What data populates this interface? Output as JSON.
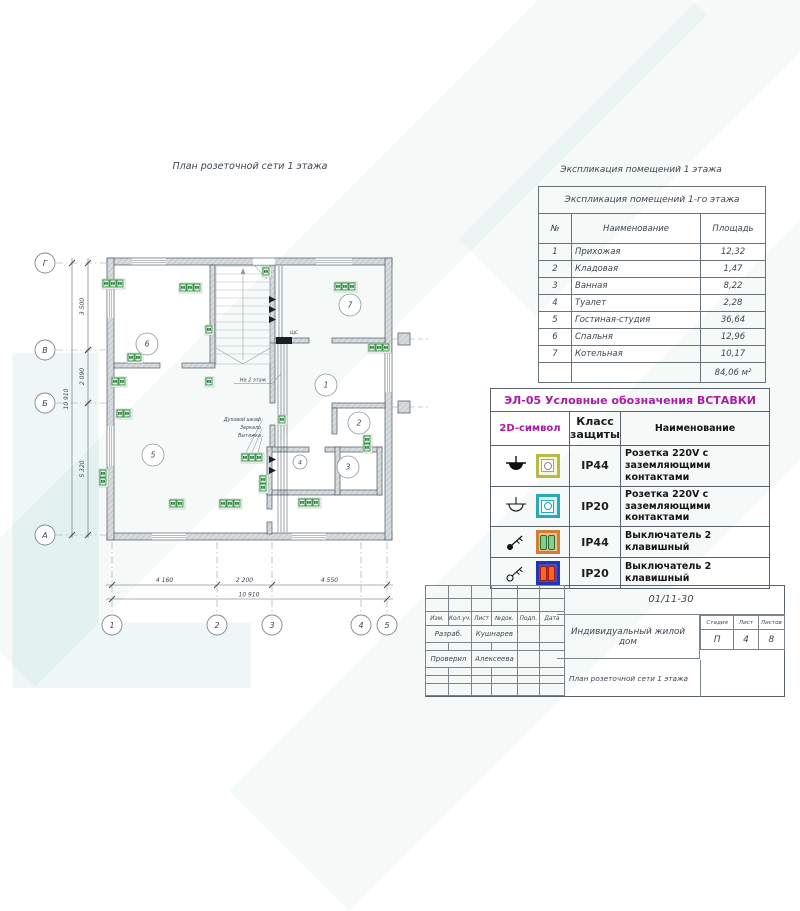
{
  "plan": {
    "title": "План розеточной сети 1 этажа",
    "panel_label": "ЩС",
    "stairs_label": "На 2 этаж",
    "annotations": [
      "Духовой шкаф",
      "Зеркало",
      "Вытяжка"
    ],
    "h_axes": [
      {
        "label": "Г",
        "y": 33
      },
      {
        "label": "В",
        "y": 120
      },
      {
        "label": "Б",
        "y": 173
      },
      {
        "label": "А",
        "y": 305
      }
    ],
    "v_axes": [
      {
        "label": "1",
        "x": 92
      },
      {
        "label": "2",
        "x": 197
      },
      {
        "label": "3",
        "x": 252
      },
      {
        "label": "4",
        "x": 341
      },
      {
        "label": "5",
        "x": 367
      }
    ],
    "left_dims": [
      {
        "label": "3 500",
        "from": 33,
        "to": 120
      },
      {
        "label": "2 090",
        "from": 120,
        "to": 173
      },
      {
        "label": "5 320",
        "from": 173,
        "to": 305
      }
    ],
    "left_total": "10 910",
    "bottom_dims": [
      {
        "label": "4 160",
        "from": 92,
        "to": 197
      },
      {
        "label": "2 200",
        "from": 197,
        "to": 252
      },
      {
        "label": "4 550",
        "from": 252,
        "to": 367
      }
    ],
    "bottom_total": "10 910",
    "rooms": [
      {
        "n": "1",
        "x": 306,
        "y": 155
      },
      {
        "n": "2",
        "x": 339,
        "y": 193
      },
      {
        "n": "3",
        "x": 328,
        "y": 237
      },
      {
        "n": "4",
        "x": 280,
        "y": 232,
        "r": 7
      },
      {
        "n": "5",
        "x": 133,
        "y": 225
      },
      {
        "n": "6",
        "x": 127,
        "y": 114
      },
      {
        "n": "7",
        "x": 330,
        "y": 75
      }
    ],
    "sockets": [
      {
        "x": 83,
        "y": 50,
        "n": 3,
        "o": "h"
      },
      {
        "x": 160,
        "y": 54,
        "n": 3,
        "o": "h"
      },
      {
        "x": 243,
        "y": 38,
        "n": 1,
        "o": "v"
      },
      {
        "x": 315,
        "y": 53,
        "n": 3,
        "o": "h"
      },
      {
        "x": 108,
        "y": 124,
        "n": 2,
        "o": "h"
      },
      {
        "x": 186,
        "y": 96,
        "n": 1,
        "o": "v"
      },
      {
        "x": 349,
        "y": 114,
        "n": 3,
        "o": "h"
      },
      {
        "x": 92,
        "y": 148,
        "n": 2,
        "o": "h"
      },
      {
        "x": 186,
        "y": 148,
        "n": 1,
        "o": "v"
      },
      {
        "x": 97,
        "y": 180,
        "n": 2,
        "o": "h"
      },
      {
        "x": 222,
        "y": 224,
        "n": 3,
        "o": "h"
      },
      {
        "x": 200,
        "y": 270,
        "n": 3,
        "o": "h"
      },
      {
        "x": 279,
        "y": 269,
        "n": 3,
        "o": "h"
      },
      {
        "x": 240,
        "y": 246,
        "n": 2,
        "o": "v"
      },
      {
        "x": 259,
        "y": 186,
        "n": 1,
        "o": "h"
      },
      {
        "x": 344,
        "y": 206,
        "n": 2,
        "o": "v"
      },
      {
        "x": 80,
        "y": 240,
        "n": 2,
        "o": "v"
      },
      {
        "x": 150,
        "y": 270,
        "n": 2,
        "o": "h"
      }
    ]
  },
  "explication": {
    "caption": "Экспликация помещений 1 этажа",
    "title": "Экспликация помещений 1-го этажа",
    "columns": [
      "№",
      "Наименование",
      "Площадь"
    ],
    "rows": [
      [
        "1",
        "Прихожая",
        "12,32"
      ],
      [
        "2",
        "Кладовая",
        "1,47"
      ],
      [
        "3",
        "Ванная",
        "8,22"
      ],
      [
        "4",
        "Туалет",
        "2,28"
      ],
      [
        "5",
        "Гостиная-студия",
        "36,64"
      ],
      [
        "6",
        "Спальня",
        "12,96"
      ],
      [
        "7",
        "Котельная",
        "10,17"
      ]
    ],
    "total": "84,06 м²"
  },
  "legend": {
    "title": "ЭЛ-05 Условные обозначения ВСТАВКИ",
    "columns": [
      "2D-символ",
      "Класс защиты",
      "Наименование"
    ],
    "rows": [
      {
        "protection": "IP44",
        "name": "Розетка 220V с заземляющими контактами"
      },
      {
        "protection": "IP20",
        "name": "Розетка 220V с заземляющими контактами"
      },
      {
        "protection": "IP44",
        "name": "Выключатель 2 клавишный"
      },
      {
        "protection": "IP20",
        "name": "Выключатель 2 клавишный"
      }
    ]
  },
  "title_block": {
    "doc_number": "01/11-30",
    "header_cells": [
      "Изм.",
      "Кол.уч.",
      "Лист",
      "№док.",
      "Подп.",
      "Дата"
    ],
    "razrab_label": "Разраб.",
    "razrab_name": "Кушнарев",
    "proveril_label": "Проверил",
    "proveril_name": "Алексеева",
    "project": "Индивидуальный жилой дом",
    "sheet_title": "План розеточной сети 1 этажа",
    "stage_label": "Стадия",
    "sheet_label": "Лист",
    "sheets_label": "Листов",
    "stage": "П",
    "sheet": "4",
    "sheets": "8"
  },
  "colors": {
    "legend_accent": "#a81ca8",
    "socket_green": "#2e8b3d",
    "wall_line": "#4e5a63",
    "watermark_teal": "#108a73",
    "plate_ip44_socket_border": "#b9b94a",
    "plate_ip44_socket_fill": "#f6f6d8",
    "plate_ip20_socket_border": "#2aa9b0",
    "plate_ip20_socket_fill": "#d9f3f3",
    "plate_ip44_switch_border": "#d07f35",
    "plate_ip44_switch_fill": "#edbe8e",
    "plate_ip20_switch_border": "#2236b5",
    "plate_ip20_switch_fill": "#3d51c9",
    "key_green": "#8ec98e",
    "key_green_border": "#1f6f2f",
    "key_orange": "#ef6a2a",
    "key_orange_border": "#b11800"
  }
}
